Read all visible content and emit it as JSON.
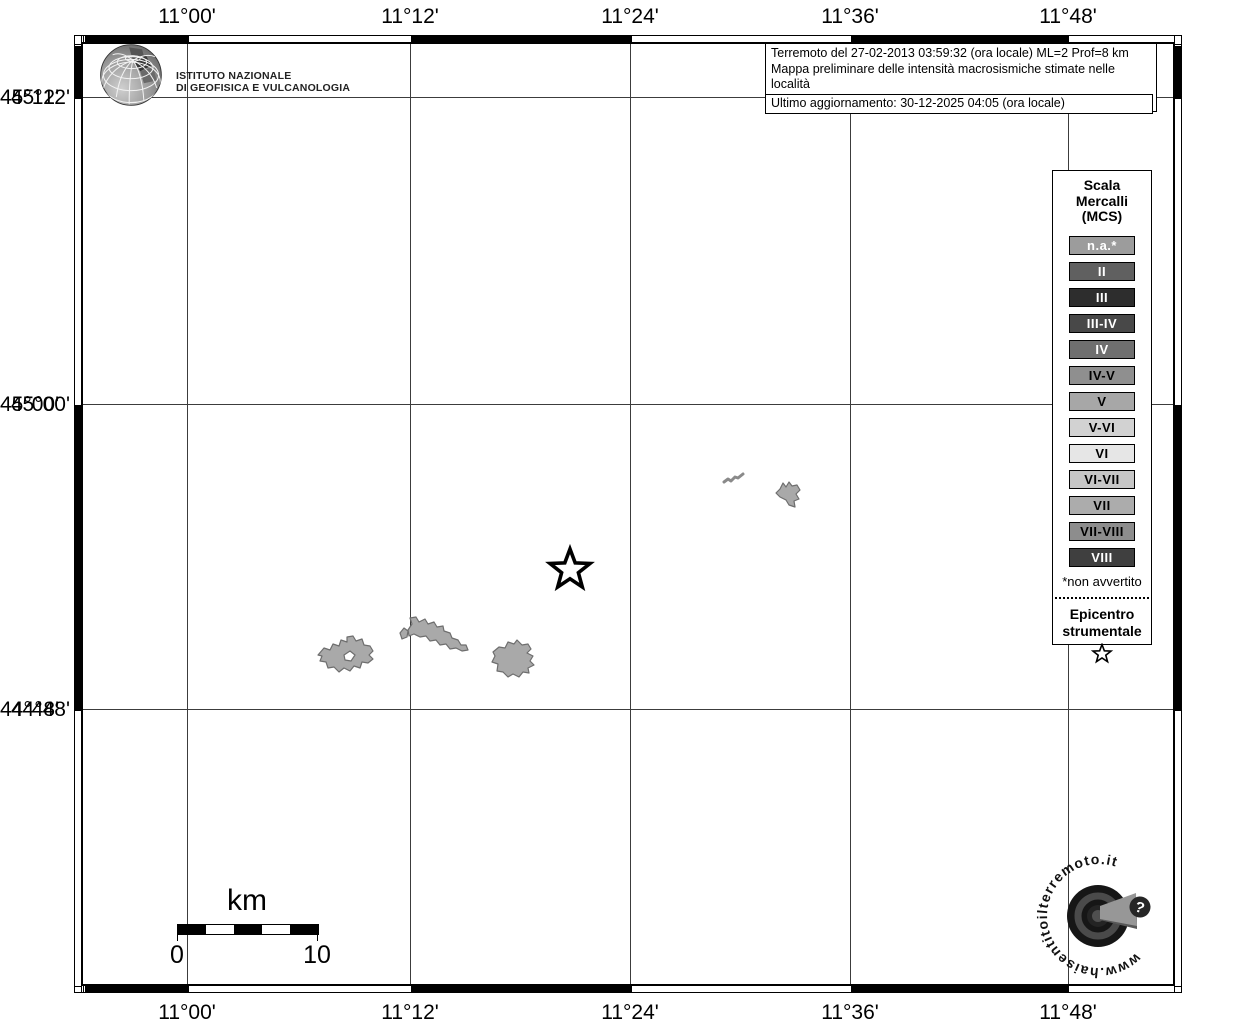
{
  "axis": {
    "lon_labels": [
      "11°00'",
      "11°12'",
      "11°24'",
      "11°36'",
      "11°48'"
    ],
    "lat_labels": [
      "45°12'",
      "45°00'",
      "44°48'"
    ]
  },
  "header": {
    "ingv_line1": "ISTITUTO NAZIONALE",
    "ingv_line2": "DI GEOFISICA E VULCANOLOGIA"
  },
  "info_box": {
    "line1": "Terremoto del 27-02-2013 03:59:32 (ora locale) ML=2 Prof=8 km",
    "line2": "Mappa preliminare delle intensità macrosismiche stimate nelle località",
    "line3": "Dati non verificati estratti da 9 questionari compilati tramite Internet.",
    "line4": "Ultimo aggiornamento: 30-12-2025 04:05 (ora locale)"
  },
  "legend": {
    "title_line1": "Scala",
    "title_line2": "Mercalli",
    "title_line3": "(MCS)",
    "items": [
      {
        "label": "n.a.*",
        "bg": "#9c9c9c",
        "fg": "#ffffff"
      },
      {
        "label": "II",
        "bg": "#606060",
        "fg": "#ffffff"
      },
      {
        "label": "III",
        "bg": "#2d2d2d",
        "fg": "#ffffff"
      },
      {
        "label": "III-IV",
        "bg": "#484848",
        "fg": "#ffffff"
      },
      {
        "label": "IV",
        "bg": "#6f6f6f",
        "fg": "#ffffff"
      },
      {
        "label": "IV-V",
        "bg": "#8f8f8f",
        "fg": "#000000"
      },
      {
        "label": "V",
        "bg": "#a7a7a7",
        "fg": "#000000"
      },
      {
        "label": "V-VI",
        "bg": "#d2d2d2",
        "fg": "#000000"
      },
      {
        "label": "VI",
        "bg": "#e6e6e6",
        "fg": "#000000"
      },
      {
        "label": "VI-VII",
        "bg": "#c6c6c6",
        "fg": "#000000"
      },
      {
        "label": "VII",
        "bg": "#acacac",
        "fg": "#000000"
      },
      {
        "label": "VII-VIII",
        "bg": "#8d8d8d",
        "fg": "#000000"
      },
      {
        "label": "VIII",
        "bg": "#3f3f3f",
        "fg": "#ffffff"
      }
    ],
    "footnote": "*non avvertito",
    "epicenter_line1": "Epicentro",
    "epicenter_line2": "strumentale"
  },
  "scale_bar": {
    "title": "km",
    "start": "0",
    "end": "10"
  },
  "watermark": {
    "url_text": "www.haisentitoilterremoto.it",
    "question_mark": "?"
  }
}
